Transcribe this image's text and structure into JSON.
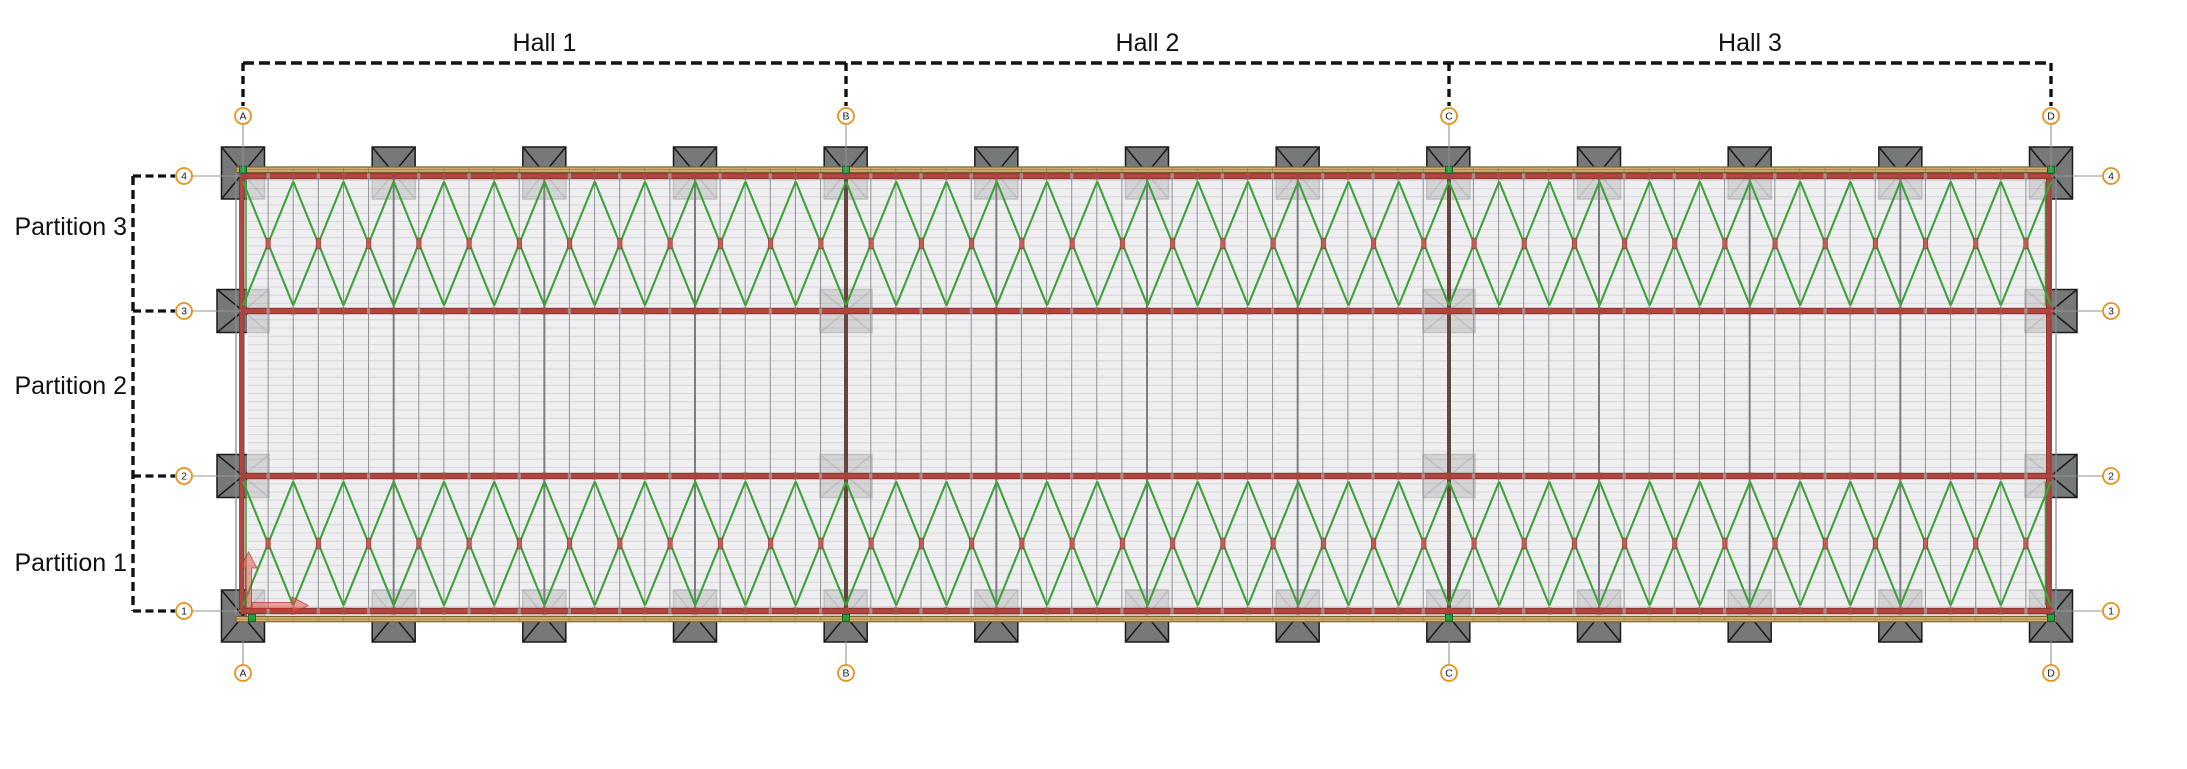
{
  "drawing": {
    "halls": [
      {
        "label": "Hall 1"
      },
      {
        "label": "Hall 2"
      },
      {
        "label": "Hall 3"
      }
    ],
    "partitions": [
      {
        "label": "Partition 3"
      },
      {
        "label": "Partition 2"
      },
      {
        "label": "Partition 1"
      }
    ],
    "grid_columns": [
      {
        "label": "A"
      },
      {
        "label": "B"
      },
      {
        "label": "C"
      },
      {
        "label": "D"
      }
    ],
    "grid_rows": [
      {
        "label": "4"
      },
      {
        "label": "3"
      },
      {
        "label": "2"
      },
      {
        "label": "1"
      }
    ],
    "colors": {
      "deck_fill": "rgba(235,235,237,0.80)",
      "deck_line": "rgba(130,130,140,0.22)",
      "rafter": "#97989b",
      "frame": "#7d7e81",
      "hall_divider": "#5a4a46",
      "hall_divider_core": "#803a31",
      "beam_red": "#b2453f",
      "beam_red_dark": "#7c2d29",
      "joint_gray": "#a6a7a9",
      "conn_red": "#a4453c",
      "cross_marker": "#bf5e55",
      "cross_marker_edge": "#8e3631",
      "edge_tan": "#d2ae6e",
      "edge_tan_dark": "#6e5a2c",
      "brace_green": "#3da23a",
      "node_green": "#22a13c",
      "node_green_dark": "#14632a",
      "column_fill": "#77787a",
      "column_line": "#1a1a1a",
      "wall_gray": "#8b8c8f",
      "grid_bubble": "#e8921e",
      "annotation": "#111111",
      "leader": "#939396",
      "ucs_red": "rgba(229,77,66,0.5)",
      "ucs_red_edge": "rgba(180,40,30,0.65)"
    }
  }
}
